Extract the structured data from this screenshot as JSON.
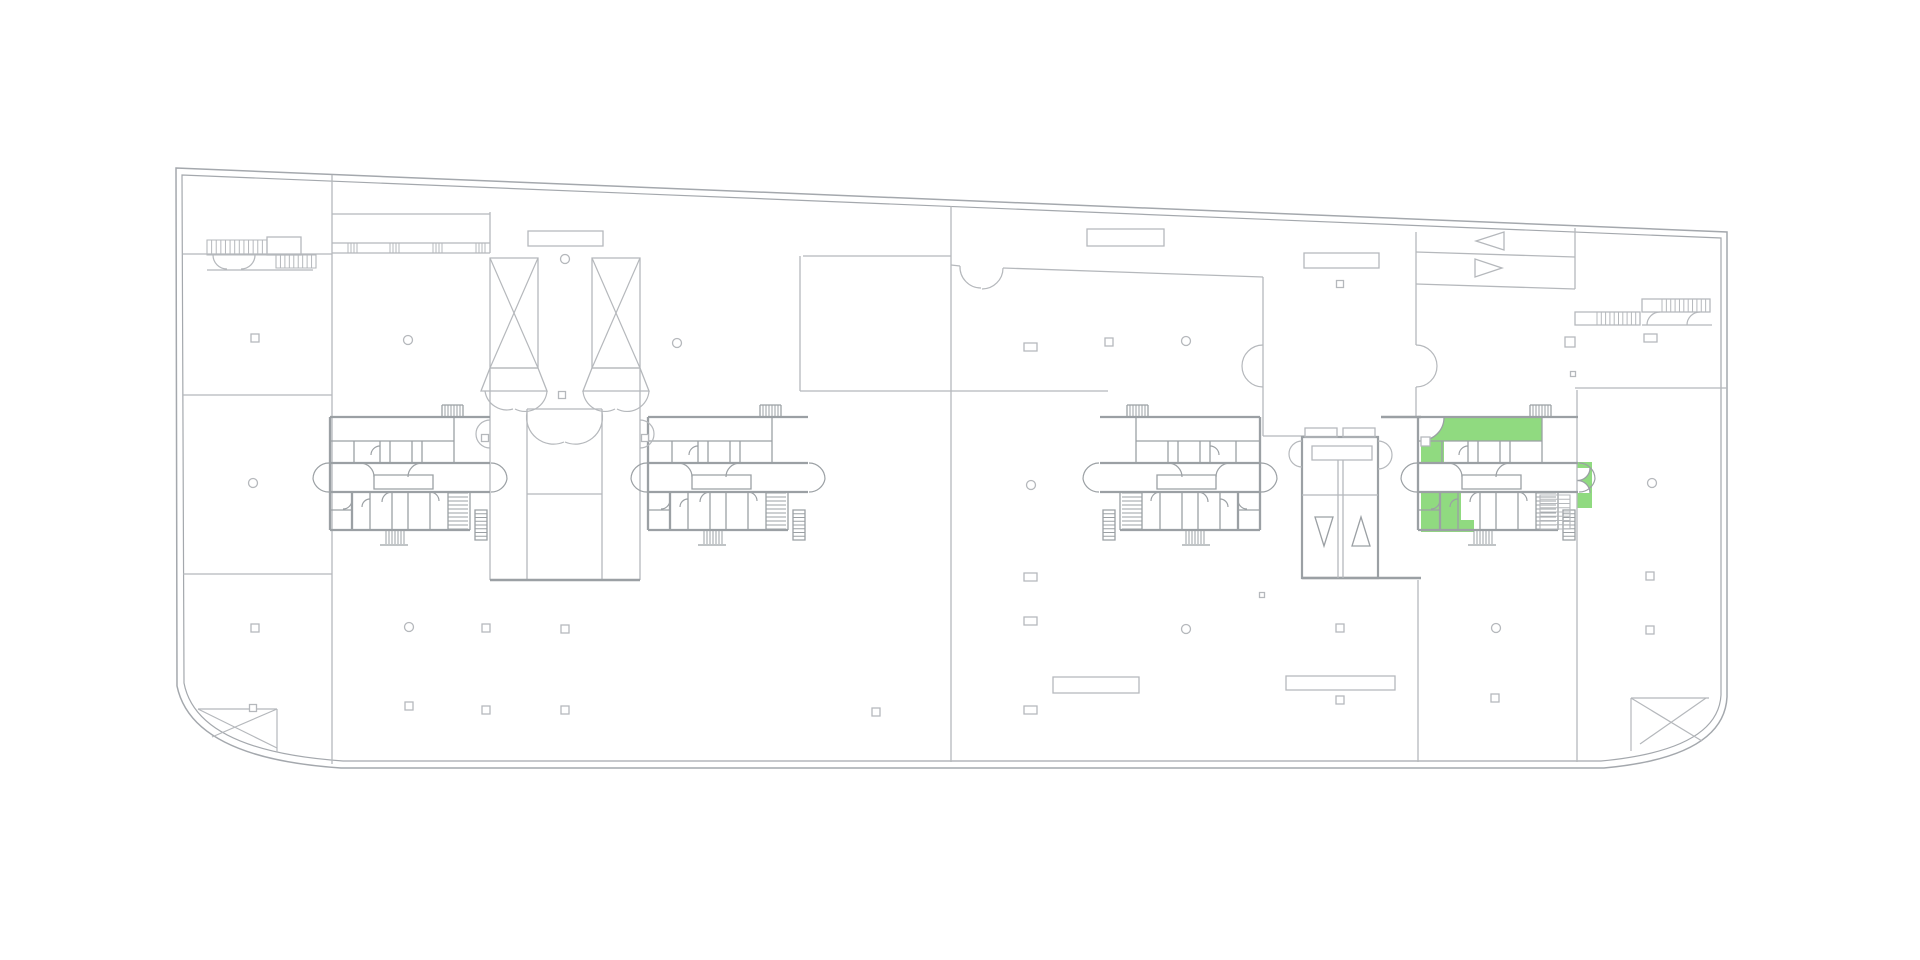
{
  "app": {
    "title": "building-floor-plan",
    "type": "architectural-plan-viewer",
    "background": "#ffffff"
  },
  "colors": {
    "thin": "#b5b8bc",
    "medium": "#9ba0a4",
    "outline": "#a4a8ad",
    "highlight": "#90da80",
    "white": "#ffffff"
  },
  "canvas": {
    "width": 1920,
    "height": 960
  },
  "highlighted_unit": {
    "name": "selected-apartment-unit",
    "color": "#90da80",
    "location": "right-wing-core",
    "shapes": [
      {
        "x": 1421,
        "y": 417.5,
        "w": 121,
        "h": 23.5
      },
      {
        "x": 1421,
        "y": 441,
        "w": 23,
        "h": 22
      },
      {
        "x": 1421,
        "y": 493,
        "w": 40,
        "h": 27
      },
      {
        "x": 1421,
        "y": 520,
        "w": 53,
        "h": 12
      },
      {
        "x": 1577.5,
        "y": 462,
        "w": 14.5,
        "h": 46
      }
    ],
    "white_cuts": [
      {
        "d": "M1421 417.5 L1444 417.5 A23 23 0 0 1 1421 440.5 Z"
      },
      {
        "d": "M1577.5 468 L1590 468 A12.5 12.5 0 0 1 1577.5 480.5 Z"
      },
      {
        "d": "M1577.5 493 L1590 493 A12.5 12.5 0 0 0 1577.5 480.5 Z"
      }
    ],
    "cut_arcs": [
      {
        "d": "M1444 417.5 A23 23 0 0 1 1421 440.5"
      },
      {
        "d": "M1590 468 A12.5 12.5 0 0 1 1577.5 480.5"
      },
      {
        "d": "M1590 493 A12.5 12.5 0 0 0 1577.5 480.5"
      }
    ]
  },
  "floorplan": {
    "outline": {
      "outer": "M176 168 L1727 232 L1727 697 Q1724 757 1604 768 L341 768 Q192 758 177 686 L176 168 Z",
      "inner": "M182 175 L1721 238 L1721 695 Q1718 750 1601 761 L343 761 Q197 751 184 683 L182 175 Z"
    },
    "thin_lines": [
      {
        "x1": 183,
        "y1": 254,
        "x2": 332,
        "y2": 254
      },
      {
        "x1": 183,
        "y1": 395,
        "x2": 332,
        "y2": 395
      },
      {
        "x1": 183,
        "y1": 574,
        "x2": 332,
        "y2": 574
      },
      {
        "x1": 332,
        "y1": 175,
        "x2": 332,
        "y2": 764
      },
      {
        "x1": 332,
        "y1": 214,
        "x2": 490,
        "y2": 214
      },
      {
        "x1": 332,
        "y1": 243,
        "x2": 490,
        "y2": 243
      },
      {
        "x1": 332,
        "y1": 253,
        "x2": 490,
        "y2": 253
      },
      {
        "x1": 490,
        "y1": 212,
        "x2": 490,
        "y2": 253
      },
      {
        "x1": 803,
        "y1": 256,
        "x2": 951,
        "y2": 256
      },
      {
        "x1": 800,
        "y1": 256,
        "x2": 800,
        "y2": 391
      },
      {
        "x1": 800,
        "y1": 391,
        "x2": 1108,
        "y2": 391
      },
      {
        "x1": 951,
        "y1": 206,
        "x2": 951,
        "y2": 762
      },
      {
        "x1": 951,
        "y1": 265,
        "x2": 960,
        "y2": 266
      },
      {
        "x1": 1003,
        "y1": 268,
        "x2": 1263,
        "y2": 277
      },
      {
        "x1": 1263,
        "y1": 277,
        "x2": 1263,
        "y2": 436
      },
      {
        "x1": 1263,
        "y1": 436,
        "x2": 1305,
        "y2": 436
      },
      {
        "x1": 1416,
        "y1": 232,
        "x2": 1416,
        "y2": 345
      },
      {
        "x1": 1416,
        "y1": 387,
        "x2": 1416,
        "y2": 417
      },
      {
        "x1": 1416,
        "y1": 252,
        "x2": 1575,
        "y2": 257
      },
      {
        "x1": 1416,
        "y1": 284,
        "x2": 1575,
        "y2": 289
      },
      {
        "x1": 1575,
        "y1": 228,
        "x2": 1575,
        "y2": 289
      },
      {
        "x1": 1575,
        "y1": 388,
        "x2": 1727,
        "y2": 388
      },
      {
        "x1": 1577,
        "y1": 390,
        "x2": 1577,
        "y2": 762
      },
      {
        "x1": 1418,
        "y1": 580,
        "x2": 1418,
        "y2": 762
      },
      {
        "x1": 207,
        "y1": 270,
        "x2": 313,
        "y2": 270
      },
      {
        "x1": 490,
        "y1": 368,
        "x2": 490,
        "y2": 580
      },
      {
        "x1": 640,
        "y1": 368,
        "x2": 640,
        "y2": 580
      },
      {
        "x1": 527,
        "y1": 409,
        "x2": 527,
        "y2": 580
      },
      {
        "x1": 602,
        "y1": 409,
        "x2": 602,
        "y2": 580
      },
      {
        "x1": 527,
        "y1": 409,
        "x2": 602,
        "y2": 409
      },
      {
        "x1": 527,
        "y1": 494,
        "x2": 602,
        "y2": 494
      },
      {
        "x1": 1642,
        "y1": 325,
        "x2": 1712,
        "y2": 325
      }
    ],
    "thin_rects": [
      {
        "x": 1087,
        "y": 229,
        "w": 77,
        "h": 17
      },
      {
        "x": 1304,
        "y": 253,
        "w": 75,
        "h": 15
      },
      {
        "x": 1053,
        "y": 677,
        "w": 86,
        "h": 16
      },
      {
        "x": 1286,
        "y": 676,
        "w": 109,
        "h": 14
      },
      {
        "x": 528,
        "y": 231,
        "w": 75,
        "h": 15
      },
      {
        "x": 267,
        "y": 237,
        "w": 34,
        "h": 18
      },
      {
        "x": 1575,
        "y": 312,
        "w": 65,
        "h": 13
      },
      {
        "x": 1642,
        "y": 299,
        "w": 68,
        "h": 13
      }
    ],
    "medium_lines": [
      {
        "x1": 1381,
        "y1": 417,
        "x2": 1421,
        "y2": 417
      },
      {
        "x1": 1302,
        "y1": 578,
        "x2": 1421,
        "y2": 578
      },
      {
        "x1": 490,
        "y1": 580,
        "x2": 640,
        "y2": 580
      }
    ],
    "corner_details": [
      {
        "x1": 198,
        "y1": 709,
        "x2": 277,
        "y2": 709
      },
      {
        "x1": 277,
        "y1": 709,
        "x2": 277,
        "y2": 752
      },
      {
        "x1": 198,
        "y1": 709,
        "x2": 277,
        "y2": 748
      },
      {
        "x1": 277,
        "y1": 709,
        "x2": 212,
        "y2": 737
      },
      {
        "x1": 1631,
        "y1": 698,
        "x2": 1709,
        "y2": 698
      },
      {
        "x1": 1631,
        "y1": 698,
        "x2": 1631,
        "y2": 751
      },
      {
        "x1": 1631,
        "y1": 698,
        "x2": 1702,
        "y2": 741
      },
      {
        "x1": 1706,
        "y1": 698,
        "x2": 1640,
        "y2": 744
      }
    ],
    "xshafts": {
      "rects": [
        {
          "x": 490,
          "y": 258,
          "w": 48,
          "h": 110
        },
        {
          "x": 592,
          "y": 258,
          "w": 48,
          "h": 110
        }
      ],
      "diagonals": [
        {
          "x1": 490,
          "y1": 258,
          "x2": 538,
          "y2": 368
        },
        {
          "x1": 538,
          "y1": 258,
          "x2": 490,
          "y2": 368
        },
        {
          "x1": 592,
          "y1": 258,
          "x2": 640,
          "y2": 368
        },
        {
          "x1": 640,
          "y1": 258,
          "x2": 592,
          "y2": 368
        }
      ],
      "funnels": [
        {
          "pts": "490,368 538,368 547,391 481,391"
        },
        {
          "pts": "592,368 640,368 649,391 583,391"
        }
      ]
    },
    "elevator_core": {
      "outer": {
        "x": 1302,
        "y": 437,
        "w": 76,
        "h": 141
      },
      "top_boxes": [
        {
          "x": 1305,
          "y": 428,
          "w": 32,
          "h": 9
        },
        {
          "x": 1343,
          "y": 428,
          "w": 32,
          "h": 9
        }
      ],
      "label_box": {
        "x": 1312,
        "y": 446,
        "w": 60,
        "h": 14
      },
      "inner_lines": [
        {
          "x1": 1338,
          "y1": 460,
          "x2": 1338,
          "y2": 578
        },
        {
          "x1": 1343,
          "y1": 460,
          "x2": 1343,
          "y2": 578
        },
        {
          "x1": 1302,
          "y1": 495,
          "x2": 1378,
          "y2": 495
        }
      ],
      "triangles": [
        {
          "pts": "1315,517 1333,517 1324,546"
        },
        {
          "pts": "1352,546 1370,546 1361,517"
        }
      ]
    },
    "door_arcs": [
      {
        "d": "M960 266 A21 21 0 0 0 981 288"
      },
      {
        "d": "M1003 268 A21 21 0 0 1 982 289"
      },
      {
        "d": "M1263 345 A21 21 0 0 0 1242 366"
      },
      {
        "d": "M1263 387 A21 21 0 0 1 1242 366"
      },
      {
        "d": "M1416 345 A21 21 0 0 1 1437 366"
      },
      {
        "d": "M1416 387 A21 21 0 0 0 1437 366"
      },
      {
        "d": "M490 420 A14 14 0 0 0 476 434"
      },
      {
        "d": "M490 448 A14 14 0 0 1 476 434"
      },
      {
        "d": "M640 420 A14 14 0 0 1 654 434"
      },
      {
        "d": "M640 448 A14 14 0 0 0 654 434"
      },
      {
        "d": "M527 412 A27 27 0 0 0 564 442"
      },
      {
        "d": "M602 412 A27 27 0 0 1 565 442"
      },
      {
        "d": "M485 391 A22 22 0 0 0 513 409"
      },
      {
        "d": "M547 391 A22 22 0 0 1 515 409"
      },
      {
        "d": "M583 391 A22 22 0 0 0 615 409"
      },
      {
        "d": "M649 391 A22 22 0 0 1 617 409"
      },
      {
        "d": "M1302 441 A13 13 0 0 0 1289 454"
      },
      {
        "d": "M1302 467 A13 13 0 0 1 1289 454"
      },
      {
        "d": "M1378 441 A14 14 0 0 1 1392 455"
      },
      {
        "d": "M1378 469 A14 14 0 0 0 1392 455"
      },
      {
        "d": "M213 255 A14 14 0 0 0 227 269"
      },
      {
        "d": "M255 255 A14 14 0 0 1 241 269"
      },
      {
        "d": "M1660 312 A13 13 0 0 0 1647 325"
      },
      {
        "d": "M1700 312 A13 13 0 0 0 1687 325"
      }
    ],
    "hatches": [
      {
        "x": 207,
        "y": 240,
        "w": 60,
        "h": 15,
        "n": 13,
        "dir": "v",
        "outline": true
      },
      {
        "x": 276,
        "y": 255,
        "w": 40,
        "h": 13,
        "n": 9,
        "dir": "v",
        "outline": true
      },
      {
        "x": 348,
        "y": 243,
        "w": 9,
        "h": 10,
        "n": 3,
        "dir": "v",
        "outline": false
      },
      {
        "x": 390,
        "y": 243,
        "w": 9,
        "h": 10,
        "n": 3,
        "dir": "v",
        "outline": false
      },
      {
        "x": 433,
        "y": 243,
        "w": 9,
        "h": 10,
        "n": 3,
        "dir": "v",
        "outline": false
      },
      {
        "x": 476,
        "y": 243,
        "w": 9,
        "h": 10,
        "n": 3,
        "dir": "v",
        "outline": false
      },
      {
        "x": 1597,
        "y": 312,
        "w": 43,
        "h": 13,
        "n": 10,
        "dir": "v",
        "outline": false
      },
      {
        "x": 1662,
        "y": 299,
        "w": 48,
        "h": 13,
        "n": 11,
        "dir": "v",
        "outline": false
      },
      {
        "x": 1540,
        "y": 495,
        "w": 30,
        "h": 34,
        "n": 8,
        "dir": "h",
        "outline": true
      }
    ],
    "columns": {
      "circles": [
        {
          "cx": 565,
          "cy": 259
        },
        {
          "cx": 408,
          "cy": 340
        },
        {
          "cx": 677,
          "cy": 343
        },
        {
          "cx": 1186,
          "cy": 341
        },
        {
          "cx": 253,
          "cy": 483
        },
        {
          "cx": 1031,
          "cy": 485
        },
        {
          "cx": 1652,
          "cy": 483
        },
        {
          "cx": 409,
          "cy": 627
        },
        {
          "cx": 1186,
          "cy": 629
        },
        {
          "cx": 1496,
          "cy": 628
        }
      ],
      "squares": [
        {
          "x": 255,
          "y": 338,
          "s": 8
        },
        {
          "x": 1109,
          "y": 342,
          "s": 8
        },
        {
          "x": 1340,
          "y": 284,
          "s": 7
        },
        {
          "x": 1570,
          "y": 342,
          "s": 10
        },
        {
          "x": 1573,
          "y": 374,
          "s": 5
        },
        {
          "x": 255,
          "y": 628,
          "s": 8
        },
        {
          "x": 486,
          "y": 628,
          "s": 8
        },
        {
          "x": 565,
          "y": 629,
          "s": 8
        },
        {
          "x": 1340,
          "y": 628,
          "s": 8
        },
        {
          "x": 1650,
          "y": 576,
          "s": 8
        },
        {
          "x": 1650,
          "y": 630,
          "s": 8
        },
        {
          "x": 253,
          "y": 708,
          "s": 7
        },
        {
          "x": 409,
          "y": 706,
          "s": 8
        },
        {
          "x": 486,
          "y": 710,
          "s": 8
        },
        {
          "x": 565,
          "y": 710,
          "s": 8
        },
        {
          "x": 876,
          "y": 712,
          "s": 8
        },
        {
          "x": 1340,
          "y": 700,
          "s": 8
        },
        {
          "x": 1495,
          "y": 698,
          "s": 8
        },
        {
          "x": 1262,
          "y": 595,
          "s": 5
        },
        {
          "x": 562,
          "y": 395,
          "s": 7
        },
        {
          "x": 485,
          "y": 438,
          "s": 7
        },
        {
          "x": 645,
          "y": 438,
          "s": 7
        }
      ],
      "wide_rects": [
        {
          "x": 1024,
          "y": 343,
          "w": 13,
          "h": 8
        },
        {
          "x": 1644,
          "y": 334,
          "w": 13,
          "h": 8
        },
        {
          "x": 1024,
          "y": 573,
          "w": 13,
          "h": 8
        },
        {
          "x": 1024,
          "y": 617,
          "w": 13,
          "h": 8
        },
        {
          "x": 1024,
          "y": 706,
          "w": 13,
          "h": 8
        },
        {
          "x": 1421,
          "y": 437,
          "w": 9,
          "h": 9
        }
      ]
    },
    "arrow_triangles": [
      {
        "pts": "1504,232 1504,250 1476,241"
      },
      {
        "pts": "1475,259 1475,277 1502,268"
      }
    ],
    "cluster_template": {
      "width": 160,
      "walls_medium": [
        {
          "x1": 0,
          "y1": 15,
          "x2": 160,
          "y2": 15
        },
        {
          "x1": 0,
          "y1": 61,
          "x2": 160,
          "y2": 61
        },
        {
          "x1": 0,
          "y1": 90,
          "x2": 160,
          "y2": 90
        },
        {
          "x1": 0,
          "y1": 15,
          "x2": 0,
          "y2": 128
        },
        {
          "x1": 0,
          "y1": 128,
          "x2": 140,
          "y2": 128
        },
        {
          "x1": 22,
          "y1": 90,
          "x2": 22,
          "y2": 128
        }
      ],
      "walls_thin": [
        {
          "x1": 0,
          "y1": 39,
          "x2": 124,
          "y2": 39
        },
        {
          "x1": 24,
          "y1": 39,
          "x2": 24,
          "y2": 61
        },
        {
          "x1": 50,
          "y1": 39,
          "x2": 50,
          "y2": 61
        },
        {
          "x1": 60,
          "y1": 39,
          "x2": 60,
          "y2": 61
        },
        {
          "x1": 82,
          "y1": 39,
          "x2": 82,
          "y2": 61
        },
        {
          "x1": 92,
          "y1": 39,
          "x2": 92,
          "y2": 61
        },
        {
          "x1": 124,
          "y1": 15,
          "x2": 124,
          "y2": 61
        },
        {
          "x1": 40,
          "y1": 90,
          "x2": 40,
          "y2": 128
        },
        {
          "x1": 62,
          "y1": 90,
          "x2": 62,
          "y2": 128
        },
        {
          "x1": 78,
          "y1": 90,
          "x2": 78,
          "y2": 128
        },
        {
          "x1": 100,
          "y1": 90,
          "x2": 100,
          "y2": 128
        },
        {
          "x1": 118,
          "y1": 90,
          "x2": 118,
          "y2": 128
        },
        {
          "x1": 140,
          "y1": 90,
          "x2": 140,
          "y2": 128
        },
        {
          "x1": 0,
          "y1": 108,
          "x2": 22,
          "y2": 108
        },
        {
          "x1": 112,
          "y1": 3,
          "x2": 133,
          "y2": 3
        },
        {
          "x1": 112,
          "y1": 3,
          "x2": 112,
          "y2": 15
        },
        {
          "x1": 133,
          "y1": 3,
          "x2": 133,
          "y2": 15
        },
        {
          "x1": 50,
          "y1": 143,
          "x2": 78,
          "y2": 143
        }
      ],
      "rects": [
        {
          "x": 44,
          "y": 73,
          "w": 59,
          "h": 14
        },
        {
          "x": 145,
          "y": 108,
          "w": 12,
          "h": 30
        }
      ],
      "hatches": [
        {
          "x": 112,
          "y": 3,
          "w": 21,
          "h": 12,
          "n": 7,
          "dir": "v"
        },
        {
          "x": 118,
          "y": 91,
          "w": 20,
          "h": 36,
          "n": 9,
          "dir": "h"
        },
        {
          "x": 56,
          "y": 129,
          "w": 18,
          "h": 13,
          "n": 6,
          "dir": "v"
        },
        {
          "x": 145,
          "y": 108,
          "w": 12,
          "h": 30,
          "n": 8,
          "dir": "h"
        }
      ],
      "arcs": [
        {
          "d": "M30 61 A14 14 0 0 1 44 75"
        },
        {
          "d": "M92 61 A14 14 0 0 0 78 75"
        },
        {
          "d": "M-1 61 A16 16 0 0 0 -17 77"
        },
        {
          "d": "M-1 90 A16 16 0 0 1 -17 77"
        },
        {
          "d": "M161 61 A16 16 0 0 1 177 77"
        },
        {
          "d": "M161 90 A16 16 0 0 0 177 77"
        },
        {
          "d": "M22 98 A9 9 0 0 1 13 107"
        },
        {
          "d": "M40 97 A8 8 0 0 0 32 105"
        },
        {
          "d": "M62 90 A10 10 0 0 0 52 100"
        },
        {
          "d": "M100 90 A9 9 0 0 1 109 99"
        },
        {
          "d": "M50 44 A9 9 0 0 0 41 53"
        }
      ],
      "instances": [
        {
          "name": "apartment-core-1",
          "tx": 330,
          "ty": 402,
          "sx": 1
        },
        {
          "name": "apartment-core-2",
          "tx": 648,
          "ty": 402,
          "sx": 1
        },
        {
          "name": "apartment-core-3",
          "tx": 1260,
          "ty": 402,
          "sx": -1
        },
        {
          "name": "apartment-core-4",
          "tx": 1418,
          "ty": 402,
          "sx": 1
        }
      ]
    }
  }
}
